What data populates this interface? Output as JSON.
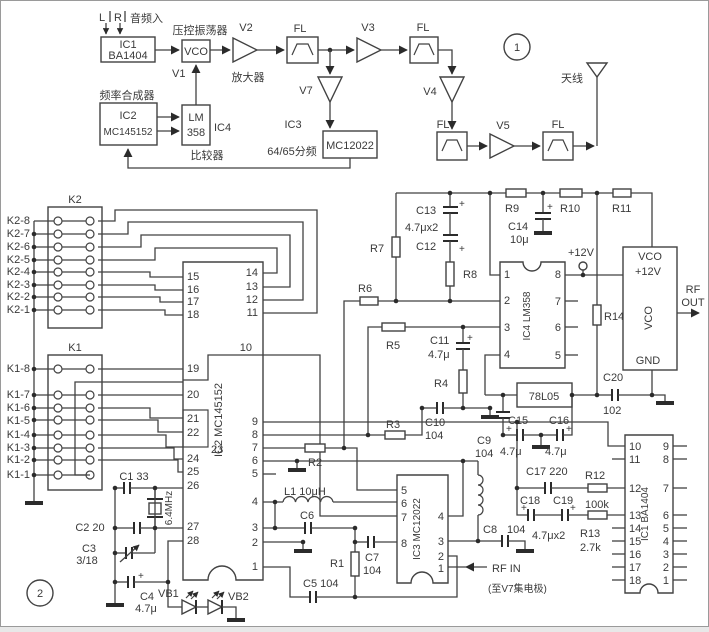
{
  "colors": {
    "ink": "#3a3a3a",
    "background": "#ffffff"
  },
  "p1": {
    "l": "L",
    "r": "R",
    "audio_in": "音频入",
    "ic1": "IC1",
    "ba1404": "BA1404",
    "vco_label": "压控振荡器",
    "vco": "VCO",
    "amp": "放大器",
    "v1": "V1",
    "v2": "V2",
    "v3": "V3",
    "v4": "V4",
    "v5": "V5",
    "v7": "V7",
    "fl": "FL",
    "synth": "频率合成器",
    "ic2": "IC2",
    "mc145152": "MC145152",
    "lm": "LM",
    "n358": "358",
    "ic4": "IC4",
    "comparator": "比较器",
    "ic3": "IC3",
    "divider": "64/65分频",
    "mc12022": "MC12022",
    "circle1": "1",
    "antenna": "天线"
  },
  "p2": {
    "k2": "K2",
    "k1": "K1",
    "k2_rows": [
      "K2-8",
      "K2-7",
      "K2-6",
      "K2-5",
      "K2-4",
      "K2-3",
      "K2-2",
      "K2-1"
    ],
    "k1_rows": [
      "K1-8",
      "K1-7",
      "K1-6",
      "K1-5",
      "K1-4",
      "K1-3",
      "K1-2",
      "K1-1"
    ],
    "ic2_name": "IC2  MC145152",
    "ic2_pins_left": [
      "15",
      "16",
      "17",
      "18",
      "19",
      "20",
      "21",
      "22",
      "23",
      "24",
      "25",
      "26",
      "27",
      "28"
    ],
    "ic2_pins_right": [
      "14",
      "13",
      "12",
      "11",
      "10",
      "9",
      "8",
      "7",
      "6",
      "5",
      "4",
      "3",
      "2",
      "1"
    ],
    "ic3_name": "IC3  MC12022",
    "ic3_pins_left": [
      "5",
      "6",
      "7",
      "8"
    ],
    "ic3_pins_right": [
      "4",
      "3",
      "2",
      "1"
    ],
    "ic4_name": "IC4  LM358",
    "ic4_pins_left": [
      "1",
      "2",
      "3",
      "4"
    ],
    "ic4_pins_right": [
      "8",
      "7",
      "6",
      "5"
    ],
    "ic1_name": "IC1  BA1404",
    "ic1_pins_left": [
      "10",
      "11",
      "12",
      "13",
      "14",
      "15",
      "16",
      "17",
      "18"
    ],
    "ic1_pins_right": [
      "9",
      "8",
      "7",
      "6",
      "5",
      "4",
      "3",
      "2",
      "1"
    ],
    "c1": "C1  33",
    "xtal": "6.4MHz",
    "c2": "C2  20",
    "c3": "C3",
    "c3v": "3/18",
    "c4": "C4",
    "c4v": "4.7μ",
    "vb1": "VB1",
    "vb2": "VB2",
    "circle2": "2",
    "r1": "R1",
    "r2": "R2",
    "r3": "R3",
    "r4": "R4",
    "r5": "R5",
    "r6": "R6",
    "r7": "R7",
    "r8": "R8",
    "r9": "R9",
    "r10": "R10",
    "r11": "R11",
    "r12": "R12",
    "r12v": "100k",
    "r13": "R13",
    "r13v": "2.7k",
    "r14": "R14",
    "c5": "C5  104",
    "c6": "C6",
    "c7": "C7",
    "c7v": "104",
    "c8": "C8",
    "c8v": "104",
    "c9": "C9",
    "c9v": "104",
    "c10": "C10",
    "c10v": "104",
    "c11": "C11",
    "c11v": "4.7μ",
    "c12": "C12",
    "c13": "C13",
    "c1312v": "4.7μx2",
    "c14": "C14",
    "c14v": "10μ",
    "c15": "C15",
    "c15v": "4.7μ",
    "c16": "C16",
    "c16v": "4.7μ",
    "c17": "C17  220",
    "c18": "C18",
    "c19": "C19",
    "c1819v": "4.7μx2",
    "c20": "C20",
    "c20v": "102",
    "l1": "L1  10μH",
    "reg": "78L05",
    "p12v": "+12V",
    "vco_top": "VCO",
    "vco_12v": "+12V",
    "vco_vert": "VCO",
    "vco_gnd": "GND",
    "rf": "RF",
    "out": "OUT",
    "rfin": "RF  IN",
    "rfin_note": "(至V7集电极)",
    "plus": "+"
  }
}
